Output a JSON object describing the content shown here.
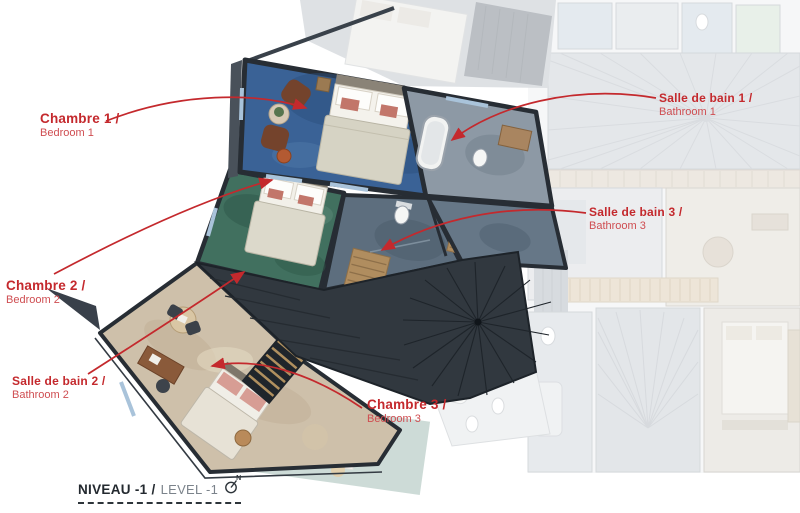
{
  "labels": [
    {
      "fr": "Chambre 1 /",
      "en": "Bedroom 1"
    },
    {
      "fr": "Chambre 2 /",
      "en": "Bedroom 2"
    },
    {
      "fr": "Salle de bain 2 /",
      "en": "Bathroom 2"
    },
    {
      "fr": "Salle de bain 1 /",
      "en": "Bathroom 1"
    },
    {
      "fr": "Salle de bain 3 /",
      "en": "Bathroom 3"
    },
    {
      "fr": "Chambre 3 /",
      "en": "Bedroom 3"
    }
  ],
  "title": {
    "fr": "NIVEAU -1 /",
    "en": "LEVEL -1",
    "compass_letter": "N"
  },
  "colors": {
    "accent": "#c4292d",
    "bedroom1_carpet": "#3a6296",
    "bedroom2_carpet": "#41705f",
    "bedroom3_wood_floor": "#cec0aa",
    "bathroom1_floor": "#8d99a5",
    "bathroom3_floor": "#5d6e7e",
    "roof_deck": "#31383f",
    "walls": "#272d34",
    "window_glazing": "#a9c3da",
    "faded_context": "#ced3d8"
  }
}
